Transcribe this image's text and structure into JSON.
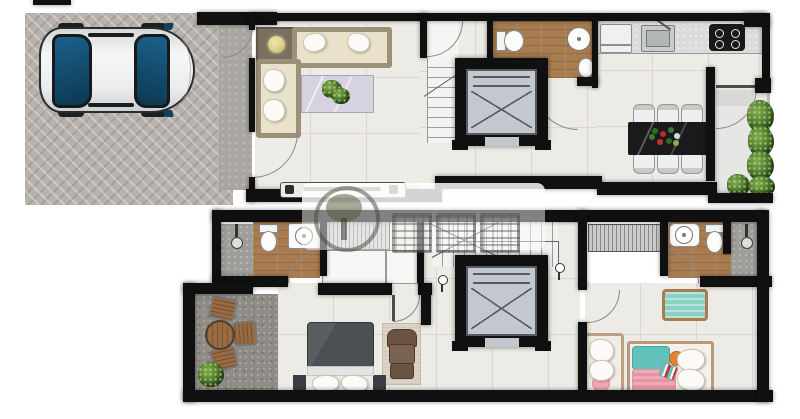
{
  "title": "Duplex residence floor plan, two storeys with garage",
  "visible_text": [],
  "watermark": {
    "type": "translucent-realtor-logo",
    "elements": [
      "tree-circle-logo",
      "three-cjk-glyph-blocks"
    ],
    "color": "#ffffff",
    "opacity": 0.55
  },
  "colors": {
    "paper": "#ffffff",
    "wall": "#101010",
    "line": "#8a8a8a",
    "floor_marble": "#edebe5",
    "tile_line": "#dbd7cf",
    "paver": "#b7b2ab",
    "porch": "#a9a59f",
    "wood": "#a87c50",
    "shower": "#9e9d9a",
    "terrace": "#8f8c86",
    "lift": "#c3c7ce",
    "lift_line": "#565b63",
    "sofa_frame": "#9b9078",
    "sofa_seat": "#e9e1ca",
    "coffee_table": "#d6d2df",
    "dining_table": "#1a1a1d",
    "counter": "#d9dcda",
    "stove": "#17181a",
    "car_glass": "#14506b",
    "bed_dark": "#4b5054",
    "rug": "#dbd4c6",
    "armchair": "#6b5243",
    "kids_teal": "#62c3bd",
    "kids_pink": "#f0aab4",
    "bench_wood": "#bba083",
    "pad_mint": "#8ad2c6",
    "table_wood": "#9a6b42"
  },
  "floors": [
    {
      "id": "upper",
      "rooms": [
        "garage",
        "entry-porch",
        "living-room",
        "stair-hall",
        "elevator",
        "bathroom",
        "kitchen",
        "dining-area",
        "balcony"
      ]
    },
    {
      "id": "lower",
      "rooms": [
        "terrace",
        "bathroom-left",
        "master-bedroom",
        "stair-hall",
        "elevator",
        "wardrobe",
        "kids-bedroom",
        "bathroom-right"
      ]
    }
  ]
}
